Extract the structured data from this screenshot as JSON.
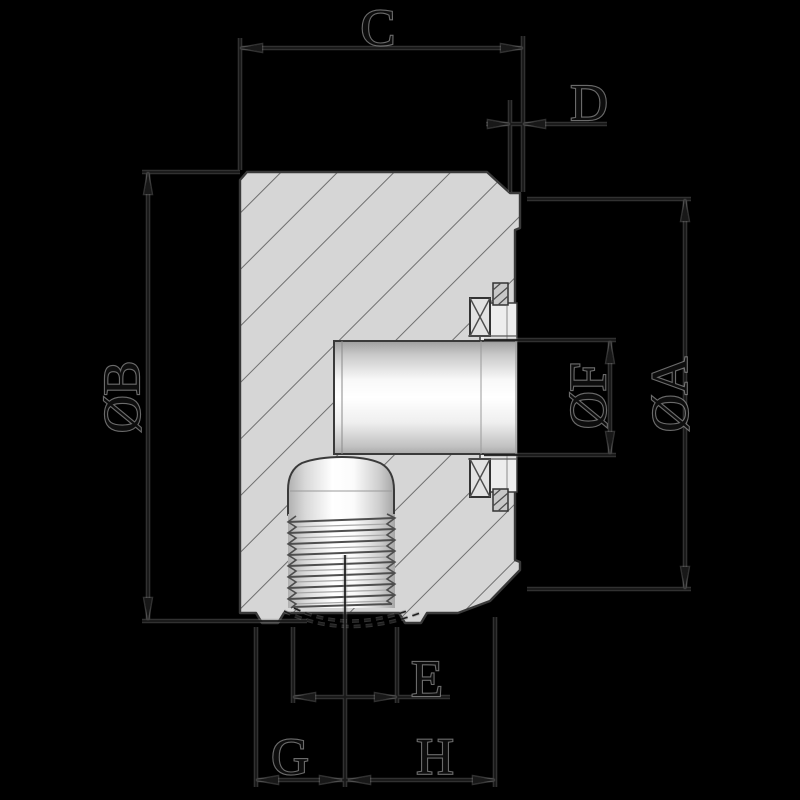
{
  "page": {
    "background": "#000000"
  },
  "drawing": {
    "kind": "engineering-cross-section",
    "description": "Sectioned cylindrical body with internal bore, bearing and retaining rings, and bottom threaded stud, annotated with letter dimensions",
    "colors": {
      "background": "#000000",
      "part_fill": "#d6d6d6",
      "hatch": "#6f6f6f",
      "outline": "#3a3a3a",
      "dimension_line": "#161616",
      "halo": "#8a8a8a"
    },
    "dimensions": {
      "top_width": "C",
      "flange_lip_width": "D",
      "body_outer_diameter": "ØB",
      "flange_outer_diameter": "ØA",
      "bore_diameter": "ØF",
      "thread_outer_diameter": "E",
      "offset_left_of_axis": "G",
      "offset_right_of_axis": "H"
    }
  }
}
